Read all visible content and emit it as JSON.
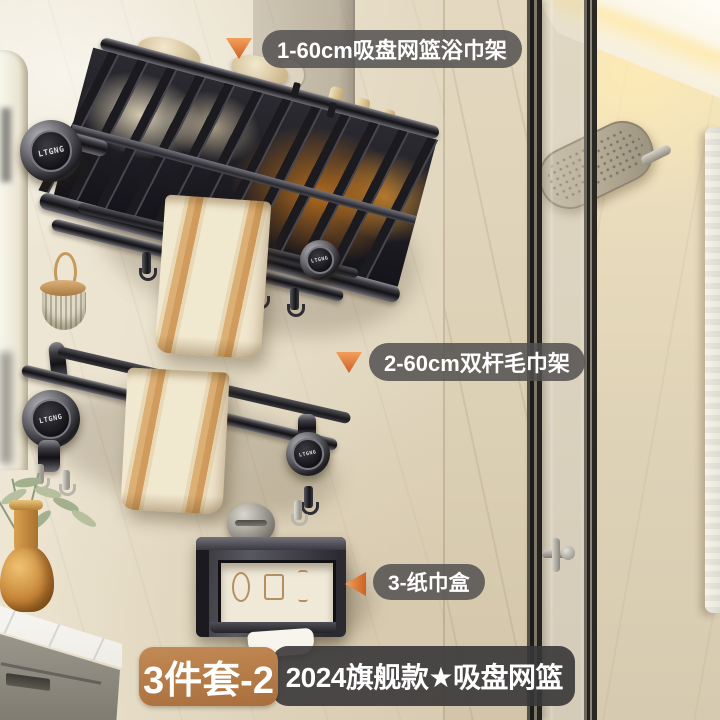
{
  "brand": {
    "logo_text": "LTGNG"
  },
  "annotations": [
    {
      "id": 1,
      "text": "1-60cm吸盘网篮浴巾架",
      "arrow": "down"
    },
    {
      "id": 2,
      "text": "2-60cm双杆毛巾架",
      "arrow": "down"
    },
    {
      "id": 3,
      "text": "3-纸巾盒",
      "arrow": "left"
    }
  ],
  "banner": {
    "set_label": "3件套-2",
    "title": "2024旗舰款★吸盘网篮"
  },
  "colors": {
    "accent_orange": "#c9804a",
    "arrow_orange": "#e0812f",
    "label_bg": "rgba(82,80,80,0.85)",
    "banner_bg": "rgba(56,55,57,0.9)",
    "metal_dark": "#2a292c",
    "towel_tan": "#d09b5c",
    "wall_cream": "#e9e1cd"
  }
}
